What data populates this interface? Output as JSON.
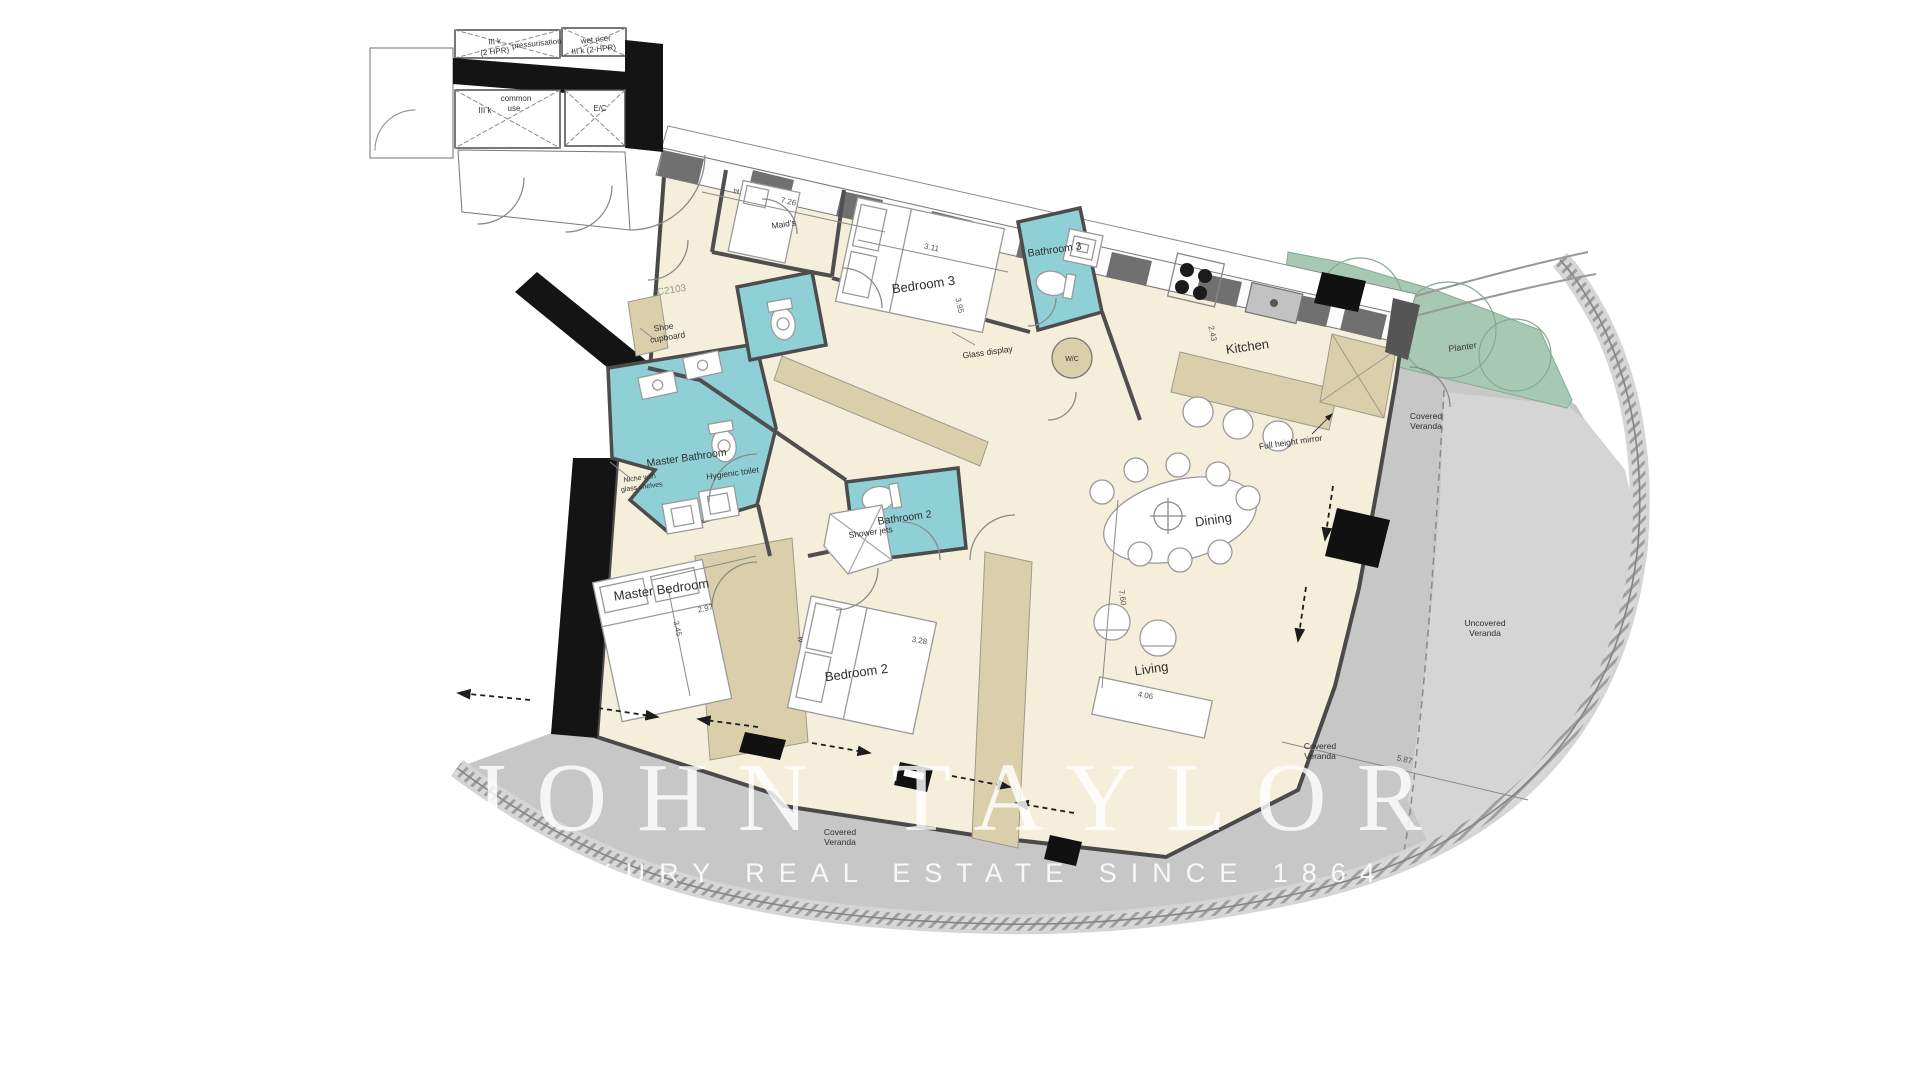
{
  "watermark": {
    "line1": "JOHN TAYLOR",
    "line2": "LUXURY REAL ESTATE SINCE 1864"
  },
  "unit_number": "C2103",
  "rooms": {
    "master_bedroom": "Master Bedroom",
    "bedroom2": "Bedroom 2",
    "bedroom3": "Bedroom 3",
    "maids": "Maid's",
    "kitchen": "Kitchen",
    "dining": "Dining",
    "living": "Living",
    "master_bathroom": "Master Bathroom",
    "bathroom2": "Bathroom 2",
    "bathroom3": "Bathroom 3",
    "wc": "W/C"
  },
  "outdoor": {
    "planter": "Planter",
    "covered": "Covered",
    "uncovered": "Uncovered",
    "veranda": "Veranda"
  },
  "annotations": {
    "shoe1": "Shoe",
    "shoe2": "cupboard",
    "glass_display": "Glass display",
    "niche1": "Niche with",
    "niche2": "glass shelves",
    "hygienic_toilet": "Hygienic toilet",
    "shower_jets": "Shower jets",
    "full_height_mirror": "Full height mirror",
    "tv": "tv"
  },
  "core": {
    "shaft1a": "III k",
    "shaft1b": "(2 HPR)",
    "pressurisation": "pressurisation",
    "wet_riser1": "wet riser",
    "wet_riser2": "III k (2-HPR)",
    "common1": "common",
    "common2": "use",
    "ec": "E/C",
    "shaft2": "III k"
  },
  "dimensions": {
    "bedroom3_w": "3.11",
    "bedroom3_d": "3.95",
    "maids_run": "7.26",
    "kitchen_d": "2.43",
    "master_d": "3.45",
    "master_w": "2.97",
    "bedroom2_w": "3.28",
    "living_l": "7.60",
    "living_w": "4.06",
    "veranda_w": "5.87"
  },
  "colors": {
    "floor": "#f5eedb",
    "wardrobe": "#dbcfab",
    "bathroom": "#8fd0d6",
    "planter": "#a7c9b3",
    "covered_veranda": "#c7c7c7",
    "uncovered_veranda": "#d5d5d5",
    "wall": "#141414"
  }
}
